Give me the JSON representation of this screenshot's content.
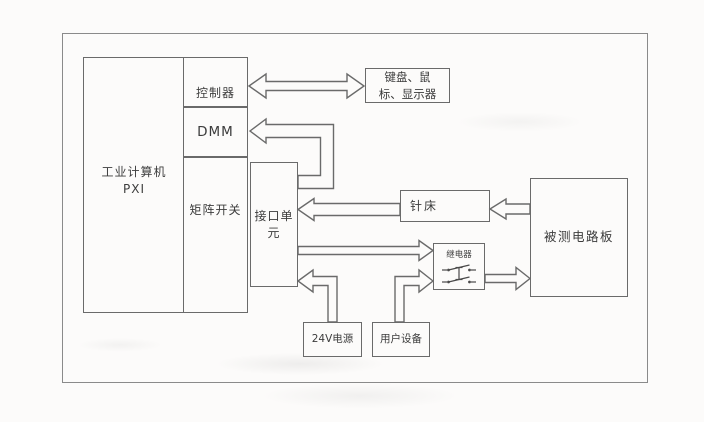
{
  "colors": {
    "line": "#6a6a6a",
    "text": "#3c3c3c",
    "bg": "#fcfbfa"
  },
  "boxes": {
    "industrial_computer": {
      "line1": "工业计算机",
      "line2": "PXI"
    },
    "controller": {
      "label": "控制器"
    },
    "dmm": {
      "label": "DMM"
    },
    "matrix_switch": {
      "label": "矩阵开关"
    },
    "interface_unit": {
      "line1": "接口单",
      "line2": "元"
    },
    "keyboard_mouse_display": {
      "line1": "键盘、鼠",
      "line2": "标、显示器"
    },
    "needle_bed": {
      "label": "针床"
    },
    "dut_board": {
      "label": "被测电路板"
    },
    "relay": {
      "label": "继电器"
    },
    "power_24v": {
      "label": "24V电源"
    },
    "user_equipment": {
      "label": "用户设备"
    }
  },
  "connections": [
    {
      "from": "控制器",
      "to": "键盘、鼠标、显示器",
      "type": "bidirectional"
    },
    {
      "from": "接口单元",
      "to": "DMM",
      "type": "one-way"
    },
    {
      "from": "针床",
      "to": "接口单元",
      "type": "one-way"
    },
    {
      "from": "被测电路板",
      "to": "针床",
      "type": "one-way"
    },
    {
      "from": "接口单元",
      "to": "继电器",
      "type": "one-way"
    },
    {
      "from": "24V电源",
      "to": "接口单元",
      "type": "one-way"
    },
    {
      "from": "用户设备",
      "to": "继电器",
      "type": "one-way"
    },
    {
      "from": "继电器",
      "to": "被测电路板",
      "type": "one-way"
    }
  ]
}
